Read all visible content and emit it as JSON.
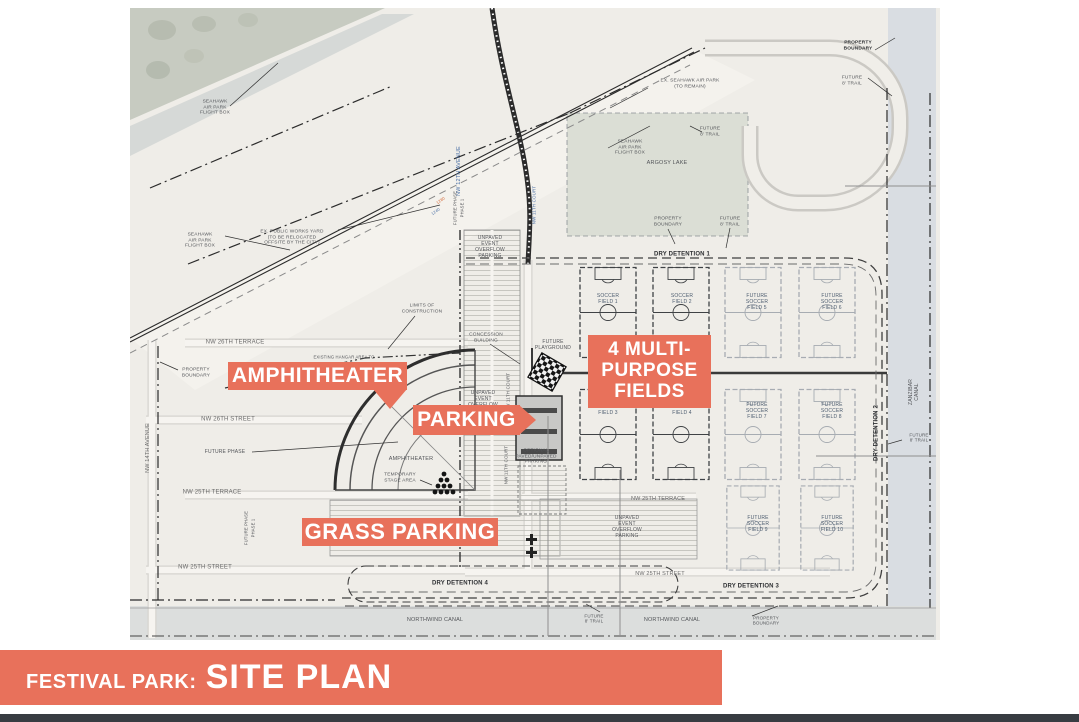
{
  "colors": {
    "accent": "#E8715B",
    "gray": "#54565A",
    "dark": "#2E3033",
    "street": "#6A6A6A",
    "blue": "#4A6FA5",
    "field": "#4D5D70",
    "orangeText": "#D2622F",
    "water": "#D9DDE2",
    "strip": "#383C42"
  },
  "title_bar": {
    "prefix": "FESTIVAL PARK:",
    "title": "SITE PLAN"
  },
  "callouts": {
    "amphitheater": {
      "label": "AMPHITHEATER"
    },
    "parking": {
      "label": "PARKING"
    },
    "multi_purpose": {
      "line1": "4 MULTI-",
      "line2": "PURPOSE",
      "line3": "FIELDS"
    },
    "grass_parking": {
      "label": "GRASS PARKING"
    }
  },
  "map": {
    "labels": [
      {
        "name": "label-seahawk-flight-box-nw",
        "text": "SEAHAWK\nAIR PARK\nFLIGHT BOX",
        "x": 85,
        "y": 100,
        "size": 4.8,
        "color": "gray"
      },
      {
        "name": "label-seahawk-flight-box-sw",
        "text": "SEAHAWK\nAIR PARK\nFLIGHT BOX",
        "x": 70,
        "y": 233,
        "size": 4.8,
        "color": "gray"
      },
      {
        "name": "label-seahawk-flight-box-e",
        "text": "SEAHAWK\nAIR PARK\nFLIGHT BOX",
        "x": 500,
        "y": 140,
        "size": 4.8,
        "color": "gray"
      },
      {
        "name": "label-public-works-yard",
        "text": "EX. PUBLIC WORKS YARD\n(TO BE RELOCATED\nOFFSITE BY THE CITY)",
        "x": 162,
        "y": 230,
        "size": 4.8,
        "color": "gray"
      },
      {
        "name": "label-ex-seahawk-air-park",
        "text": "EX. SEAHAWK AIR PARK\n(TO REMAIN)",
        "x": 560,
        "y": 76,
        "size": 4.8,
        "color": "gray"
      },
      {
        "name": "label-argosy-lake",
        "text": "ARGOSY LAKE",
        "x": 537,
        "y": 155,
        "size": 5.5,
        "color": "gray"
      },
      {
        "name": "label-property-boundary-ne",
        "text": "PROPERTY\nBOUNDARY",
        "x": 728,
        "y": 38,
        "size": 4.8,
        "color": "dark",
        "bold": true
      },
      {
        "name": "label-future-trail-ne",
        "text": "FUTURE\n8' TRAIL",
        "x": 722,
        "y": 73,
        "size": 4.8,
        "color": "gray"
      },
      {
        "name": "label-future-trail-lake-n",
        "text": "FUTURE\n8' TRAIL",
        "x": 580,
        "y": 124,
        "size": 4.8,
        "color": "gray"
      },
      {
        "name": "label-property-boundary-lake-s",
        "text": "PROPERTY\nBOUNDARY",
        "x": 538,
        "y": 214,
        "size": 4.8,
        "color": "gray"
      },
      {
        "name": "label-future-trail-lake-s",
        "text": "FUTURE\n8' TRAIL",
        "x": 600,
        "y": 214,
        "size": 4.8,
        "color": "gray"
      },
      {
        "name": "label-dry-detention-1",
        "text": "DRY DETENTION 1",
        "x": 552,
        "y": 247,
        "size": 6,
        "color": "dark",
        "bold": true
      },
      {
        "name": "label-nw-12th-avenue",
        "text": "NW 12TH AVENUE",
        "x": 329,
        "y": 163,
        "size": 5.5,
        "color": "blue",
        "rot": -90
      },
      {
        "name": "label-nw-11th-court-n",
        "text": "NW 11TH COURT",
        "x": 404,
        "y": 197,
        "size": 4.5,
        "color": "blue",
        "rot": -90
      },
      {
        "name": "label-road-station-1280",
        "text": "1280",
        "x": 311,
        "y": 193,
        "size": 4,
        "color": "orangeText",
        "rot": -35
      },
      {
        "name": "label-road-station-1240",
        "text": "1240",
        "x": 306,
        "y": 204,
        "size": 4,
        "color": "blue",
        "rot": -35
      },
      {
        "name": "label-unpaved-overflow-n",
        "text": "UNPAVED\nEVENT\nOVERFLOW\nPARKING",
        "x": 360,
        "y": 240,
        "size": 5,
        "color": "gray"
      },
      {
        "name": "label-future-phase-line-n",
        "text": "FUTURE PHASE",
        "x": 326,
        "y": 200,
        "size": 4.2,
        "color": "gray",
        "rot": -90
      },
      {
        "name": "label-phase-1-line-n",
        "text": "PHASE 1",
        "x": 333,
        "y": 200,
        "size": 4.2,
        "color": "gray",
        "rot": -90
      },
      {
        "name": "label-limits-of-construction",
        "text": "LIMITS OF\nCONSTRUCTION",
        "x": 292,
        "y": 301,
        "size": 4.8,
        "color": "gray"
      },
      {
        "name": "label-nw-26th-terrace",
        "text": "NW 26TH TERRACE",
        "x": 105,
        "y": 335,
        "size": 6,
        "color": "street"
      },
      {
        "name": "label-property-boundary-w",
        "text": "PROPERTY\nBOUNDARY",
        "x": 66,
        "y": 365,
        "size": 4.8,
        "color": "gray"
      },
      {
        "name": "label-existing-hangar-area",
        "text": "EXISTING HANGAR AREA TO",
        "x": 214,
        "y": 350,
        "size": 4.2,
        "color": "gray"
      },
      {
        "name": "label-concession-building",
        "text": "CONCESSION\nBUILDING",
        "x": 356,
        "y": 330,
        "size": 4.8,
        "color": "gray"
      },
      {
        "name": "label-future-playground",
        "text": "FUTURE\nPLAYGROUND",
        "x": 423,
        "y": 338,
        "size": 5,
        "color": "gray"
      },
      {
        "name": "label-nw-26th-street",
        "text": "NW 26TH STREET",
        "x": 98,
        "y": 412,
        "size": 6,
        "color": "street"
      },
      {
        "name": "label-future-phase-w",
        "text": "FUTURE PHASE",
        "x": 95,
        "y": 445,
        "size": 5,
        "color": "gray"
      },
      {
        "name": "label-nw-14th-avenue",
        "text": "NW 14TH AVENUE",
        "x": 18,
        "y": 440,
        "size": 5.5,
        "color": "street",
        "rot": -90
      },
      {
        "name": "label-amphitheater-small",
        "text": "AMPHITHEATER",
        "x": 281,
        "y": 451,
        "size": 5.5,
        "color": "gray"
      },
      {
        "name": "label-temporary-stage-area",
        "text": "TEMPORARY\nSTAGE AREA",
        "x": 270,
        "y": 470,
        "size": 4.8,
        "color": "gray"
      },
      {
        "name": "label-nw-25th-terrace-w",
        "text": "NW 25TH TERRACE",
        "x": 82,
        "y": 485,
        "size": 6,
        "color": "street"
      },
      {
        "name": "label-nw-25th-street-w",
        "text": "NW 25TH STREET",
        "x": 75,
        "y": 560,
        "size": 6,
        "color": "street"
      },
      {
        "name": "label-future-phase-s",
        "text": "FUTURE PHASE",
        "x": 117,
        "y": 520,
        "size": 4.2,
        "color": "gray",
        "rot": -90
      },
      {
        "name": "label-phase-1-s",
        "text": "PHASE 1",
        "x": 124,
        "y": 520,
        "size": 4.2,
        "color": "gray",
        "rot": -90
      },
      {
        "name": "label-unpaved-overflow-w",
        "text": "UNPAVED\nEVENT\nOVERFLOW",
        "x": 353,
        "y": 392,
        "size": 5,
        "color": "gray"
      },
      {
        "name": "label-nw-11th-court-mid",
        "text": "NW 11TH COURT",
        "x": 378,
        "y": 384,
        "size": 4.5,
        "color": "gray",
        "rot": -90
      },
      {
        "name": "label-nw-11th-court-s",
        "text": "NW 11TH COURT",
        "x": 376,
        "y": 457,
        "size": 4.5,
        "color": "gray",
        "rot": -90
      },
      {
        "name": "label-optional-parking",
        "text": "OPTIONAL\nPAVED/UNPAVED\nPARKING",
        "x": 406,
        "y": 449,
        "size": 4.8,
        "color": "gray"
      },
      {
        "name": "label-soccer-field-1",
        "text": "SOCCER\nFIELD 1",
        "x": 478,
        "y": 292,
        "size": 5,
        "color": "field"
      },
      {
        "name": "label-soccer-field-2",
        "text": "SOCCER\nFIELD 2",
        "x": 552,
        "y": 292,
        "size": 5,
        "color": "field"
      },
      {
        "name": "label-soccer-field-3",
        "text": "SOCCER\nFIELD 3",
        "x": 478,
        "y": 403,
        "size": 5,
        "color": "field"
      },
      {
        "name": "label-soccer-field-4",
        "text": "SOCCER\nFIELD 4",
        "x": 552,
        "y": 403,
        "size": 5,
        "color": "field"
      },
      {
        "name": "label-future-soccer-field-5",
        "text": "FUTURE\nSOCCER\nFIELD 5",
        "x": 627,
        "y": 295,
        "size": 5,
        "color": "field"
      },
      {
        "name": "label-future-soccer-field-6",
        "text": "FUTURE\nSOCCER\nFIELD 6",
        "x": 702,
        "y": 295,
        "size": 5,
        "color": "field"
      },
      {
        "name": "label-future-soccer-field-7",
        "text": "FUTURE\nSOCCER\nFIELD 7",
        "x": 627,
        "y": 404,
        "size": 5,
        "color": "field"
      },
      {
        "name": "label-future-soccer-field-8",
        "text": "FUTURE\nSOCCER\nFIELD 8",
        "x": 702,
        "y": 404,
        "size": 5,
        "color": "field"
      },
      {
        "name": "label-future-soccer-field-9",
        "text": "FUTURE\nSOCCER\nFIELD 9",
        "x": 628,
        "y": 517,
        "size": 5,
        "color": "field"
      },
      {
        "name": "label-future-soccer-field-10",
        "text": "FUTURE\nSOCCER\nFIELD 10",
        "x": 702,
        "y": 517,
        "size": 5,
        "color": "field"
      },
      {
        "name": "label-dry-detention-2",
        "text": "DRY DETENTION 2",
        "x": 747,
        "y": 425,
        "size": 6,
        "color": "dark",
        "bold": true,
        "rot": -90
      },
      {
        "name": "label-zanzibar-canal",
        "text": "ZANZIBAR CANAL",
        "x": 785,
        "y": 384,
        "size": 5,
        "color": "gray",
        "rot": -90
      },
      {
        "name": "label-future-trail-e",
        "text": "FUTURE\n8' TRAIL",
        "x": 789,
        "y": 430,
        "size": 4.5,
        "color": "gray"
      },
      {
        "name": "label-nw-25th-terrace-e",
        "text": "NW 25TH TERRACE",
        "x": 528,
        "y": 491,
        "size": 5.5,
        "color": "street"
      },
      {
        "name": "label-unpaved-overflow-s",
        "text": "UNPAVED\nEVENT\nOVERFLOW\nPARKING",
        "x": 497,
        "y": 520,
        "size": 5,
        "color": "gray"
      },
      {
        "name": "label-nw-25th-street-e",
        "text": "NW 25TH STREET",
        "x": 530,
        "y": 566,
        "size": 5.5,
        "color": "street"
      },
      {
        "name": "label-dry-detention-3",
        "text": "DRY DETENTION 3",
        "x": 621,
        "y": 579,
        "size": 6,
        "color": "dark",
        "bold": true
      },
      {
        "name": "label-dry-detention-4",
        "text": "DRY DETENTION 4",
        "x": 330,
        "y": 576,
        "size": 6,
        "color": "dark",
        "bold": true
      },
      {
        "name": "label-northwind-canal-w",
        "text": "NORTHWIND CANAL",
        "x": 305,
        "y": 612,
        "size": 5.5,
        "color": "gray"
      },
      {
        "name": "label-northwind-canal-e",
        "text": "NORTHWIND CANAL",
        "x": 542,
        "y": 612,
        "size": 5.5,
        "color": "gray"
      },
      {
        "name": "label-property-boundary-s",
        "text": "PROPERTY\nBOUNDARY",
        "x": 636,
        "y": 613,
        "size": 4.5,
        "color": "gray"
      },
      {
        "name": "label-future-trail-s",
        "text": "FUTURE\n8' TRAIL",
        "x": 464,
        "y": 611,
        "size": 4.5,
        "color": "gray"
      }
    ]
  }
}
